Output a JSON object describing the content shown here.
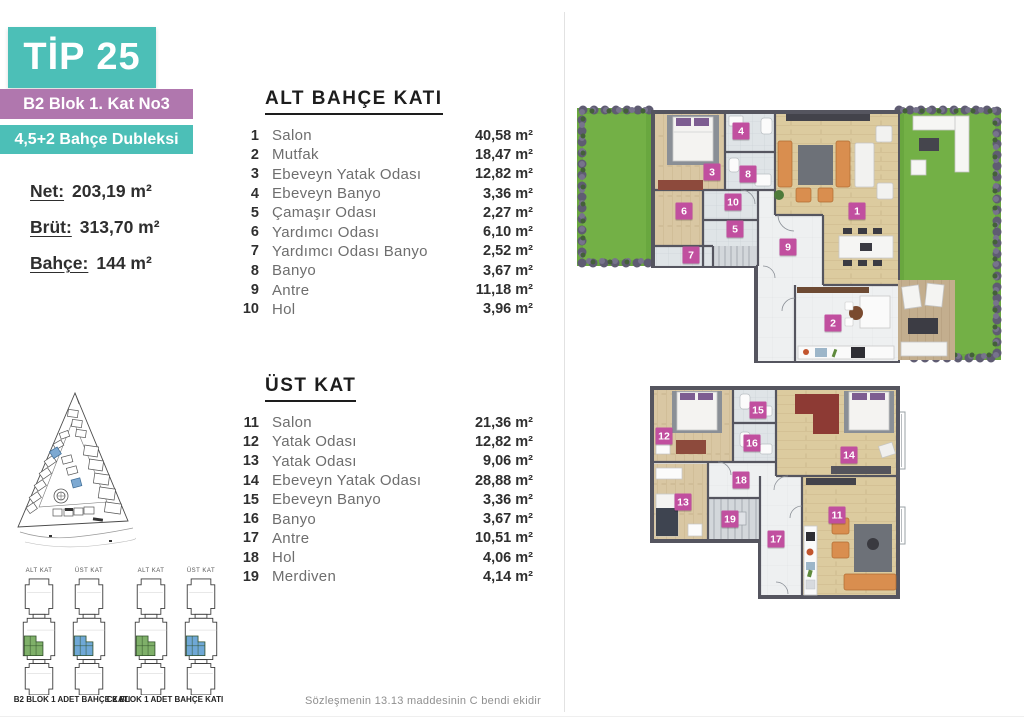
{
  "header": {
    "type_label": "TİP 25",
    "block_label": "B2 Blok 1. Kat No3",
    "unit_label": "4,5+2 Bahçe Dubleksi"
  },
  "stats": [
    {
      "label": "Net:",
      "value": "203,19 m²"
    },
    {
      "label": "Brüt:",
      "value": "313,70 m²"
    },
    {
      "label": "Bahçe:",
      "value": "144 m²"
    }
  ],
  "floors": [
    {
      "heading": "ALT BAHÇE KATI",
      "rows": [
        {
          "no": "1",
          "name": "Salon",
          "area": "40,58 m²"
        },
        {
          "no": "2",
          "name": "Mutfak",
          "area": "18,47 m²"
        },
        {
          "no": "3",
          "name": "Ebeveyn Yatak Odası",
          "area": "12,82 m²"
        },
        {
          "no": "4",
          "name": "Ebeveyn Banyo",
          "area": "3,36 m²"
        },
        {
          "no": "5",
          "name": "Çamaşır Odası",
          "area": "2,27 m²"
        },
        {
          "no": "6",
          "name": "Yardımcı Odası",
          "area": "6,10 m²"
        },
        {
          "no": "7",
          "name": "Yardımcı Odası Banyo",
          "area": "2,52 m²"
        },
        {
          "no": "8",
          "name": "Banyo",
          "area": "3,67 m²"
        },
        {
          "no": "9",
          "name": "Antre",
          "area": "11,18 m²"
        },
        {
          "no": "10",
          "name": "Hol",
          "area": "3,96 m²"
        }
      ]
    },
    {
      "heading": "ÜST KAT",
      "rows": [
        {
          "no": "11",
          "name": "Salon",
          "area": "21,36 m²"
        },
        {
          "no": "12",
          "name": "Yatak Odası",
          "area": "12,82 m²"
        },
        {
          "no": "13",
          "name": "Yatak Odası",
          "area": "9,06 m²"
        },
        {
          "no": "14",
          "name": "Ebeveyn Yatak Odası",
          "area": "28,88 m²"
        },
        {
          "no": "15",
          "name": "Ebeveyn Banyo",
          "area": "3,36 m²"
        },
        {
          "no": "16",
          "name": "Banyo",
          "area": "3,67 m²"
        },
        {
          "no": "17",
          "name": "Antre",
          "area": "10,51 m²"
        },
        {
          "no": "18",
          "name": "Hol",
          "area": "4,06 m²"
        },
        {
          "no": "19",
          "name": "Merdiven",
          "area": "4,14 m²"
        }
      ]
    }
  ],
  "floorplans": {
    "lower": {
      "badges": [
        {
          "label": "1",
          "x": 284,
          "y": 113
        },
        {
          "label": "2",
          "x": 260,
          "y": 225
        },
        {
          "label": "3",
          "x": 139,
          "y": 74
        },
        {
          "label": "4",
          "x": 168,
          "y": 33
        },
        {
          "label": "5",
          "x": 162,
          "y": 131
        },
        {
          "label": "6",
          "x": 111,
          "y": 113
        },
        {
          "label": "7",
          "x": 118,
          "y": 157
        },
        {
          "label": "8",
          "x": 175,
          "y": 76
        },
        {
          "label": "9",
          "x": 215,
          "y": 149
        },
        {
          "label": "10",
          "x": 160,
          "y": 104
        }
      ]
    },
    "upper": {
      "badges": [
        {
          "label": "11",
          "x": 189,
          "y": 129
        },
        {
          "label": "12",
          "x": 16,
          "y": 50
        },
        {
          "label": "13",
          "x": 35,
          "y": 116
        },
        {
          "label": "14",
          "x": 201,
          "y": 69
        },
        {
          "label": "15",
          "x": 110,
          "y": 24
        },
        {
          "label": "16",
          "x": 104,
          "y": 57
        },
        {
          "label": "17",
          "x": 128,
          "y": 153
        },
        {
          "label": "18",
          "x": 93,
          "y": 94
        },
        {
          "label": "19",
          "x": 82,
          "y": 133
        }
      ]
    }
  },
  "mini_diagrams": {
    "items": [
      {
        "floor_label": "ALT KAT",
        "highlight": "#7fb069"
      },
      {
        "floor_label": "ÜST KAT",
        "highlight": "#6fa8d6"
      },
      {
        "floor_label": "ALT KAT",
        "highlight": "#7fb069"
      },
      {
        "floor_label": "ÜST KAT",
        "highlight": "#6fa8d6"
      }
    ],
    "captions": [
      "B2 BLOK 1 ADET BAHÇE KATI",
      "C2 BLOK 1 ADET BAHÇE KATI"
    ]
  },
  "footer": {
    "note": "Sözleşmenin 13.13 maddesinin C bendi ekidir"
  },
  "colors": {
    "teal": "#4cbfb7",
    "purple": "#b077ae",
    "badge_magenta": "#c14f9f",
    "grass_green": "#69a73f",
    "wall_gray": "#55555f"
  }
}
